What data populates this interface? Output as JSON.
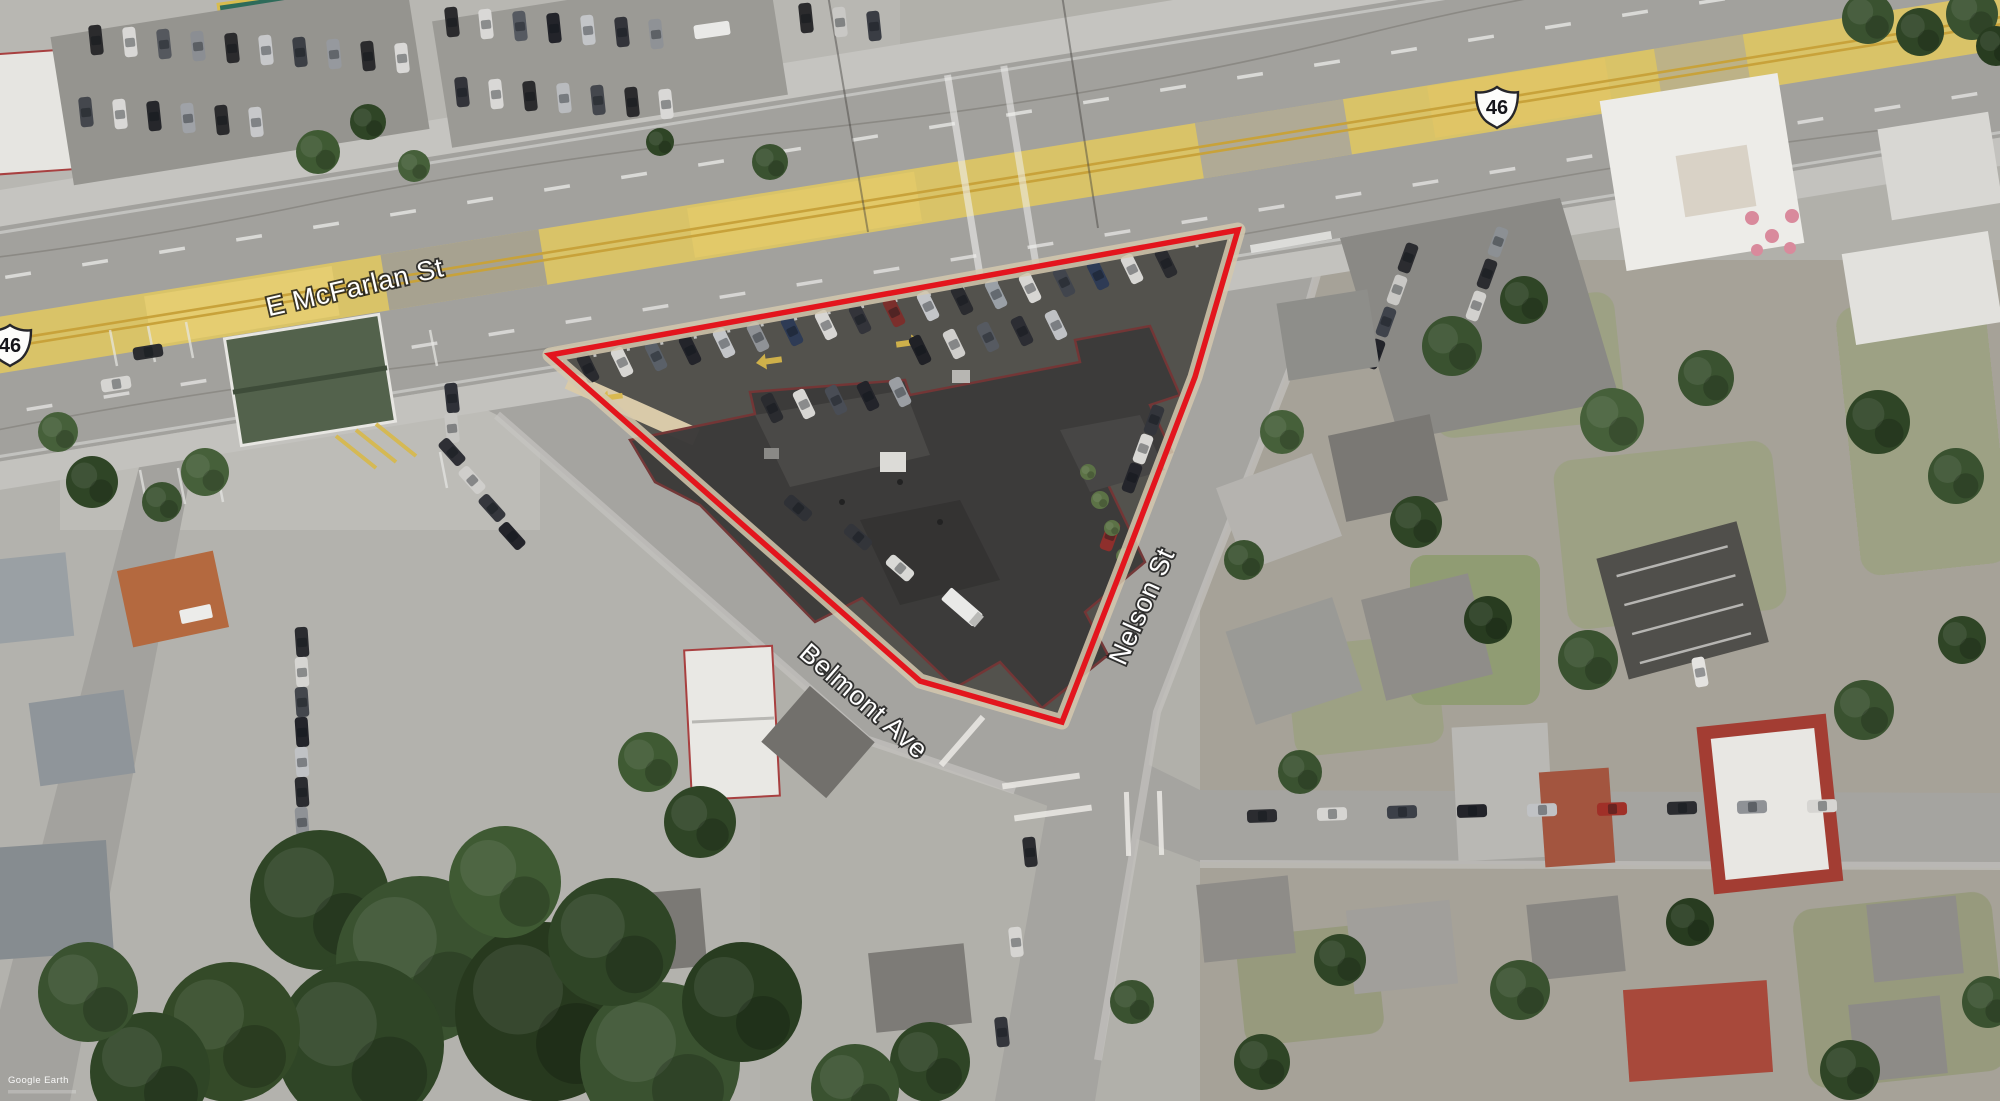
{
  "map": {
    "streets": {
      "main": "E McFarlan St",
      "belmont": "Belmont Ave",
      "nelson": "Nelson St"
    },
    "shields": {
      "left": "46",
      "right": "46"
    },
    "watermark": {
      "brand": "Google Earth"
    },
    "colors": {
      "outline_red": "#e3151d",
      "median_yellow": "#d9c368",
      "asphalt": "#a2a19d",
      "lot_asphalt": "#53524d",
      "building_roof": "#3c3b3a",
      "roof_trim_maroon": "#743636",
      "sidewalk_tan": "#d3c8ae",
      "tree_green": "#3a5230",
      "label_fill": "#ffffff",
      "label_halo": "#141414"
    }
  }
}
